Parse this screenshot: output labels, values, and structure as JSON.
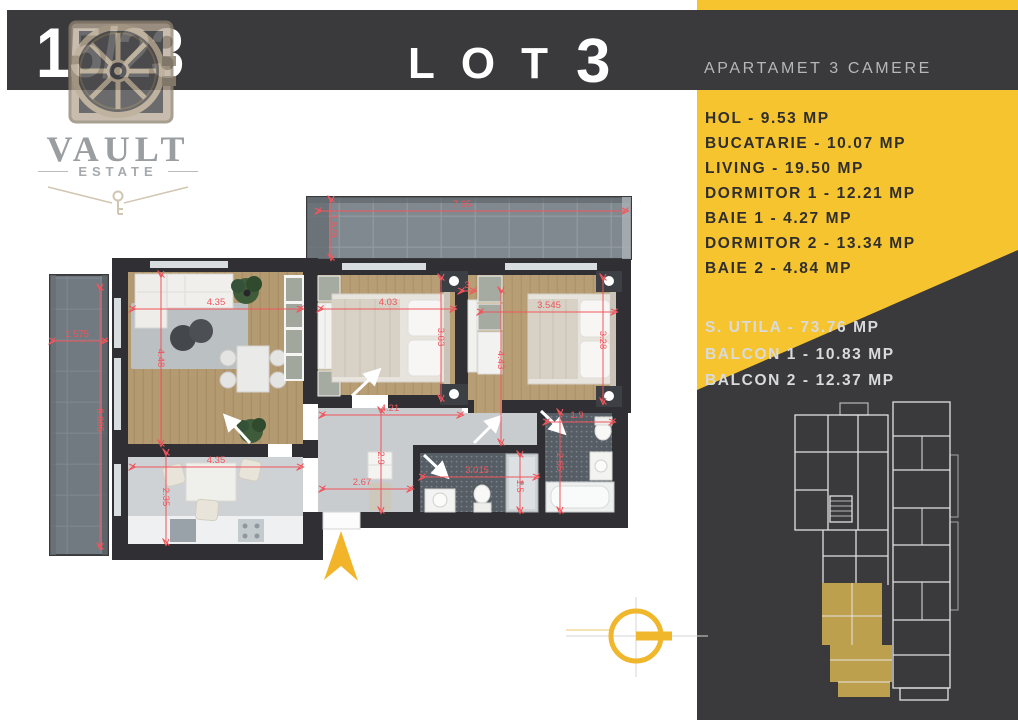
{
  "header": {
    "unit_number": "15/23",
    "lot_label": "LOT",
    "lot_number": "3",
    "subtitle": "APARTAMET 3 CAMERE"
  },
  "logo": {
    "name": "VAULT",
    "tagline": "ESTATE"
  },
  "panel": {
    "rooms": [
      "HOL - 9.53 MP",
      "BUCATARIE - 10.07 MP",
      "LIVING - 19.50 MP",
      "DORMITOR 1 - 12.21 MP",
      "BAIE 1 - 4.27 MP",
      "DORMITOR 2 - 13.34 MP",
      "BAIE 2 - 4.84 MP"
    ],
    "totals": [
      "S. UTILA - 73.76 MP",
      "BALCON 1  - 10.83 MP",
      "BALCON 2 - 12.37 MP"
    ]
  },
  "colors": {
    "accent_yellow": "#f6c42f",
    "panel_dark": "#3a393b",
    "dimension_red": "#f0555c",
    "map_highlight": "#c9a94f"
  },
  "floor_plan": {
    "dimensions": [
      {
        "label": "7.65",
        "x": 462,
        "y": 207,
        "rot": 0
      },
      {
        "label": "1.575",
        "x": 331,
        "y": 226,
        "rot": 90
      },
      {
        "label": "1.575",
        "x": 77,
        "y": 337,
        "rot": 0
      },
      {
        "label": "6.805",
        "x": 97,
        "y": 420,
        "rot": 90
      },
      {
        "label": "4.35",
        "x": 216,
        "y": 305,
        "rot": 0
      },
      {
        "label": "4.48",
        "x": 158,
        "y": 358,
        "rot": 90
      },
      {
        "label": "4.35",
        "x": 216,
        "y": 463,
        "rot": 0
      },
      {
        "label": "2.35",
        "x": 163,
        "y": 497,
        "rot": 90
      },
      {
        "label": "2.67",
        "x": 362,
        "y": 485,
        "rot": 0
      },
      {
        "label": "2.9",
        "x": 378,
        "y": 458,
        "rot": 90
      },
      {
        "label": "4.21",
        "x": 390,
        "y": 411,
        "rot": 0
      },
      {
        "label": "4.03",
        "x": 388,
        "y": 305,
        "rot": 0
      },
      {
        "label": "3.03",
        "x": 438,
        "y": 337,
        "rot": 90
      },
      {
        "label": "3",
        "x": 467,
        "y": 288,
        "rot": 0
      },
      {
        "label": "3.545",
        "x": 549,
        "y": 308,
        "rot": 0
      },
      {
        "label": "3.28",
        "x": 600,
        "y": 340,
        "rot": 90
      },
      {
        "label": "4.43",
        "x": 498,
        "y": 360,
        "rot": 90
      },
      {
        "label": "3.015",
        "x": 477,
        "y": 473,
        "rot": 0
      },
      {
        "label": "1.5",
        "x": 517,
        "y": 486,
        "rot": 90
      },
      {
        "label": "1.9",
        "x": 577,
        "y": 418,
        "rot": 0
      },
      {
        "label": "2.65",
        "x": 557,
        "y": 462,
        "rot": 90
      }
    ]
  }
}
